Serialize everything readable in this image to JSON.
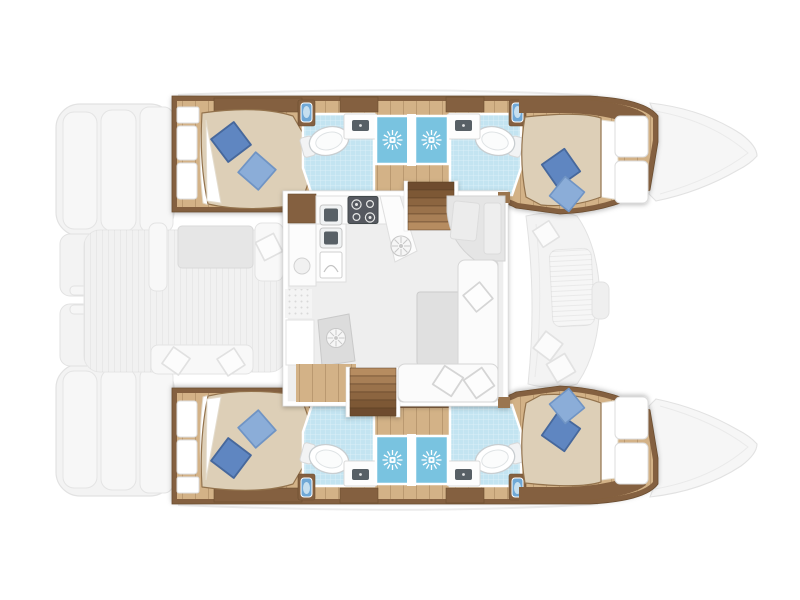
{
  "title": "Catamaran interior deck plan",
  "diagram": {
    "type": "yacht floor plan",
    "view": "top-down",
    "orientation": "bows to the right, stern swim steps to the left",
    "hulls": [
      "port hull (top)",
      "starboard hull (bottom)"
    ]
  },
  "rooms": {
    "cabins": [
      {
        "name": "port aft double cabin",
        "pillows": 2
      },
      {
        "name": "port forward double cabin",
        "pillows": 2
      },
      {
        "name": "starboard aft double cabin",
        "pillows": 2
      },
      {
        "name": "starboard forward double cabin",
        "pillows": 2
      }
    ],
    "bathrooms": [
      {
        "name": "port aft bathroom",
        "fixtures": [
          "toilet",
          "washbasin",
          "shower"
        ]
      },
      {
        "name": "port forward bathroom",
        "fixtures": [
          "toilet",
          "washbasin",
          "shower"
        ]
      },
      {
        "name": "starboard aft bathroom",
        "fixtures": [
          "toilet",
          "washbasin",
          "shower"
        ]
      },
      {
        "name": "starboard forward bathroom",
        "fixtures": [
          "toilet",
          "washbasin",
          "shower"
        ]
      }
    ],
    "saloon": {
      "features": [
        "galley with 4-burner cooktop",
        "double sink unit",
        "L-shaped sofa",
        "coffee table",
        "nav seat",
        "companionway stairs to each hull"
      ]
    },
    "exterior": {
      "features": [
        "aft cockpit with table and bench seats",
        "stern swim steps",
        "foredeck lounge seat",
        "bow peaks"
      ]
    }
  },
  "counts": {
    "cabins": 4,
    "bathrooms": 4,
    "showers": 4,
    "stairways": 2,
    "cooktop_burners": 4
  },
  "colors": {
    "wood_floor": "#d3b287",
    "wood_trim": "#84613f",
    "wood_dark": "#6b4d31",
    "bed_duvet": "#ddcfb7",
    "bed_outline": "#93734e",
    "pillow_dark": "#5e86c1",
    "pillow_dark_edge": "#46689c",
    "pillow_light": "#8badd8",
    "pillow_light_edge": "#6f94c4",
    "mattress": "#ffffff",
    "bath_tile": "#c3e4f1",
    "shower_floor": "#79c3e0",
    "vanity_blue": "#6fa8d6",
    "fixture_slot": "#596066",
    "cooktop": "#54595e",
    "counter_white": "#fcfcfc",
    "salon_floor": "#eeeeee",
    "table_gray": "#e0e0e0",
    "gray_module": "#dcdcdc",
    "sofa_white": "#fbfbfb",
    "deck_fill": "#f1f1f1",
    "ghost_fill": "#f3f3f3",
    "ghost_line": "#e2e2e2"
  }
}
